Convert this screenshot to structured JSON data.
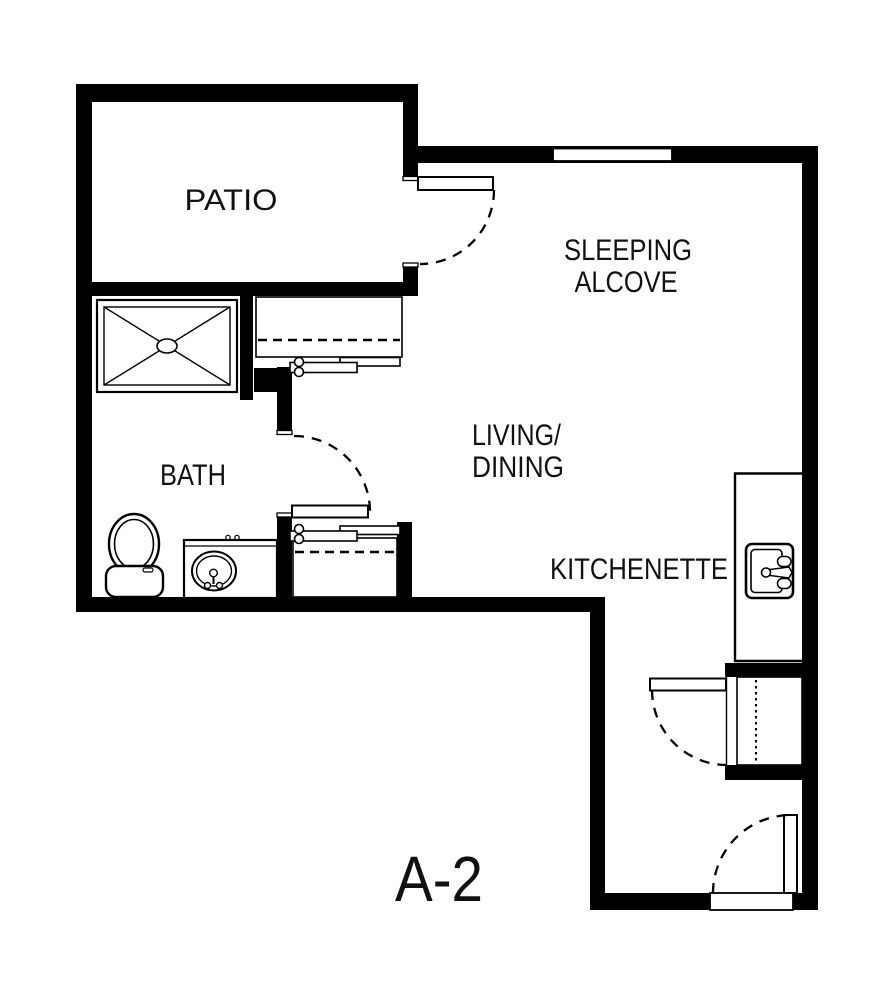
{
  "background_color": "#ffffff",
  "line_color": "#000000",
  "plan": {
    "unit_label": "A-2",
    "rooms": {
      "patio": {
        "label": "PATIO"
      },
      "sleeping_alcove": {
        "line1": "SLEEPING",
        "line2": "ALCOVE"
      },
      "living_dining": {
        "line1": "LIVING/",
        "line2": "DINING"
      },
      "bath": {
        "label": "BATH"
      },
      "kitchenette": {
        "label": "KITCHENETTE"
      }
    },
    "fixtures": [
      "shower-icon",
      "toilet-icon",
      "bathroom-sink-icon",
      "kitchen-sink-icon",
      "window-icon",
      "swing-door-icon",
      "sliding-closet-door-icon",
      "closet-rod-icon",
      "entry-threshold-icon"
    ]
  }
}
